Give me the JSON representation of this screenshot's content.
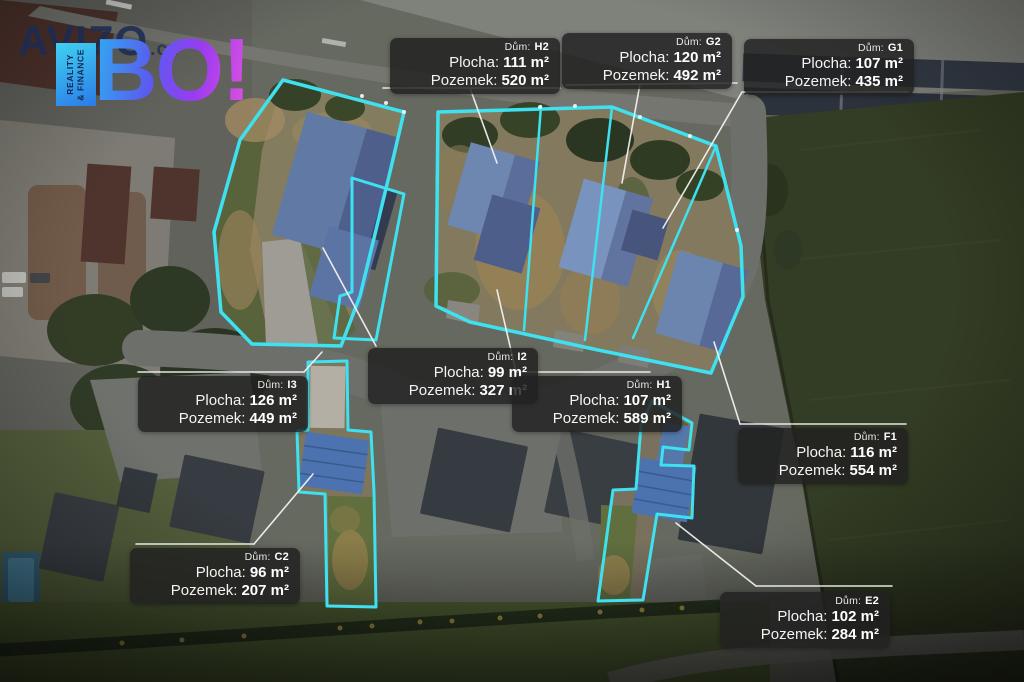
{
  "brand": {
    "avizo": "AVIZO",
    "cz": ".cz",
    "bo": "BO!",
    "tagline": "REALITY\n& FINANCE"
  },
  "field_labels": {
    "dum": "Dům:",
    "plocha": "Plocha:",
    "pozemek": "Pozemek:"
  },
  "plots": [
    {
      "house": "H2",
      "plocha": "111 m²",
      "pozemek": "520 m²"
    },
    {
      "house": "G2",
      "plocha": "120 m²",
      "pozemek": "492 m²"
    },
    {
      "house": "G1",
      "plocha": "107 m²",
      "pozemek": "435 m²"
    },
    {
      "house": "I2",
      "plocha": "99 m²",
      "pozemek": "327 m²"
    },
    {
      "house": "I3",
      "plocha": "126 m²",
      "pozemek": "449 m²"
    },
    {
      "house": "H1",
      "plocha": "107 m²",
      "pozemek": "589 m²"
    },
    {
      "house": "F1",
      "plocha": "116 m²",
      "pozemek": "554 m²"
    },
    {
      "house": "C2",
      "plocha": "96 m²",
      "pozemek": "207 m²"
    },
    {
      "house": "E2",
      "plocha": "102 m²",
      "pozemek": "284 m²"
    }
  ],
  "colors": {
    "plot_outline": "#3ee1ef",
    "roof_highlight": "#4c73af",
    "label_background": "rgba(33,33,33,0.84)",
    "brand_navy": "#1d2b52",
    "brand_gradient_start": "#2eaef0",
    "brand_gradient_end": "#d84fe2"
  }
}
